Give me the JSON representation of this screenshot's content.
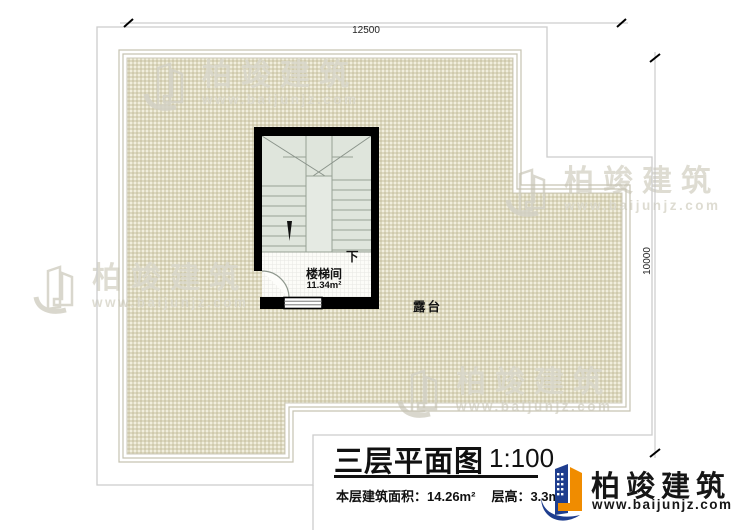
{
  "dimensions": {
    "width": "12500",
    "height": "10000"
  },
  "stairwell": {
    "name": "楼梯间",
    "area": "11.34m²",
    "direction": "下"
  },
  "terrace": {
    "name": "露台"
  },
  "title_block": {
    "title": "三层平面图",
    "scale": "1:100",
    "area_label": "本层建筑面积：",
    "area_value": "14.26m²",
    "floor_height_label": "层高：",
    "floor_height_value": "3.3m"
  },
  "logo": {
    "brand": "柏竣建筑",
    "url": "www.baijunjz.com"
  },
  "watermark": {
    "brand": "柏竣建筑",
    "url": "www.baijunjz.com"
  },
  "colors": {
    "terrace_fill": "#f1eedd",
    "stair_fill": "#dfe5dc",
    "wall": "#000000",
    "dimension_line": "#c2c2c2",
    "logo_blue": "#1f3e8f",
    "logo_orange": "#f08c00"
  }
}
